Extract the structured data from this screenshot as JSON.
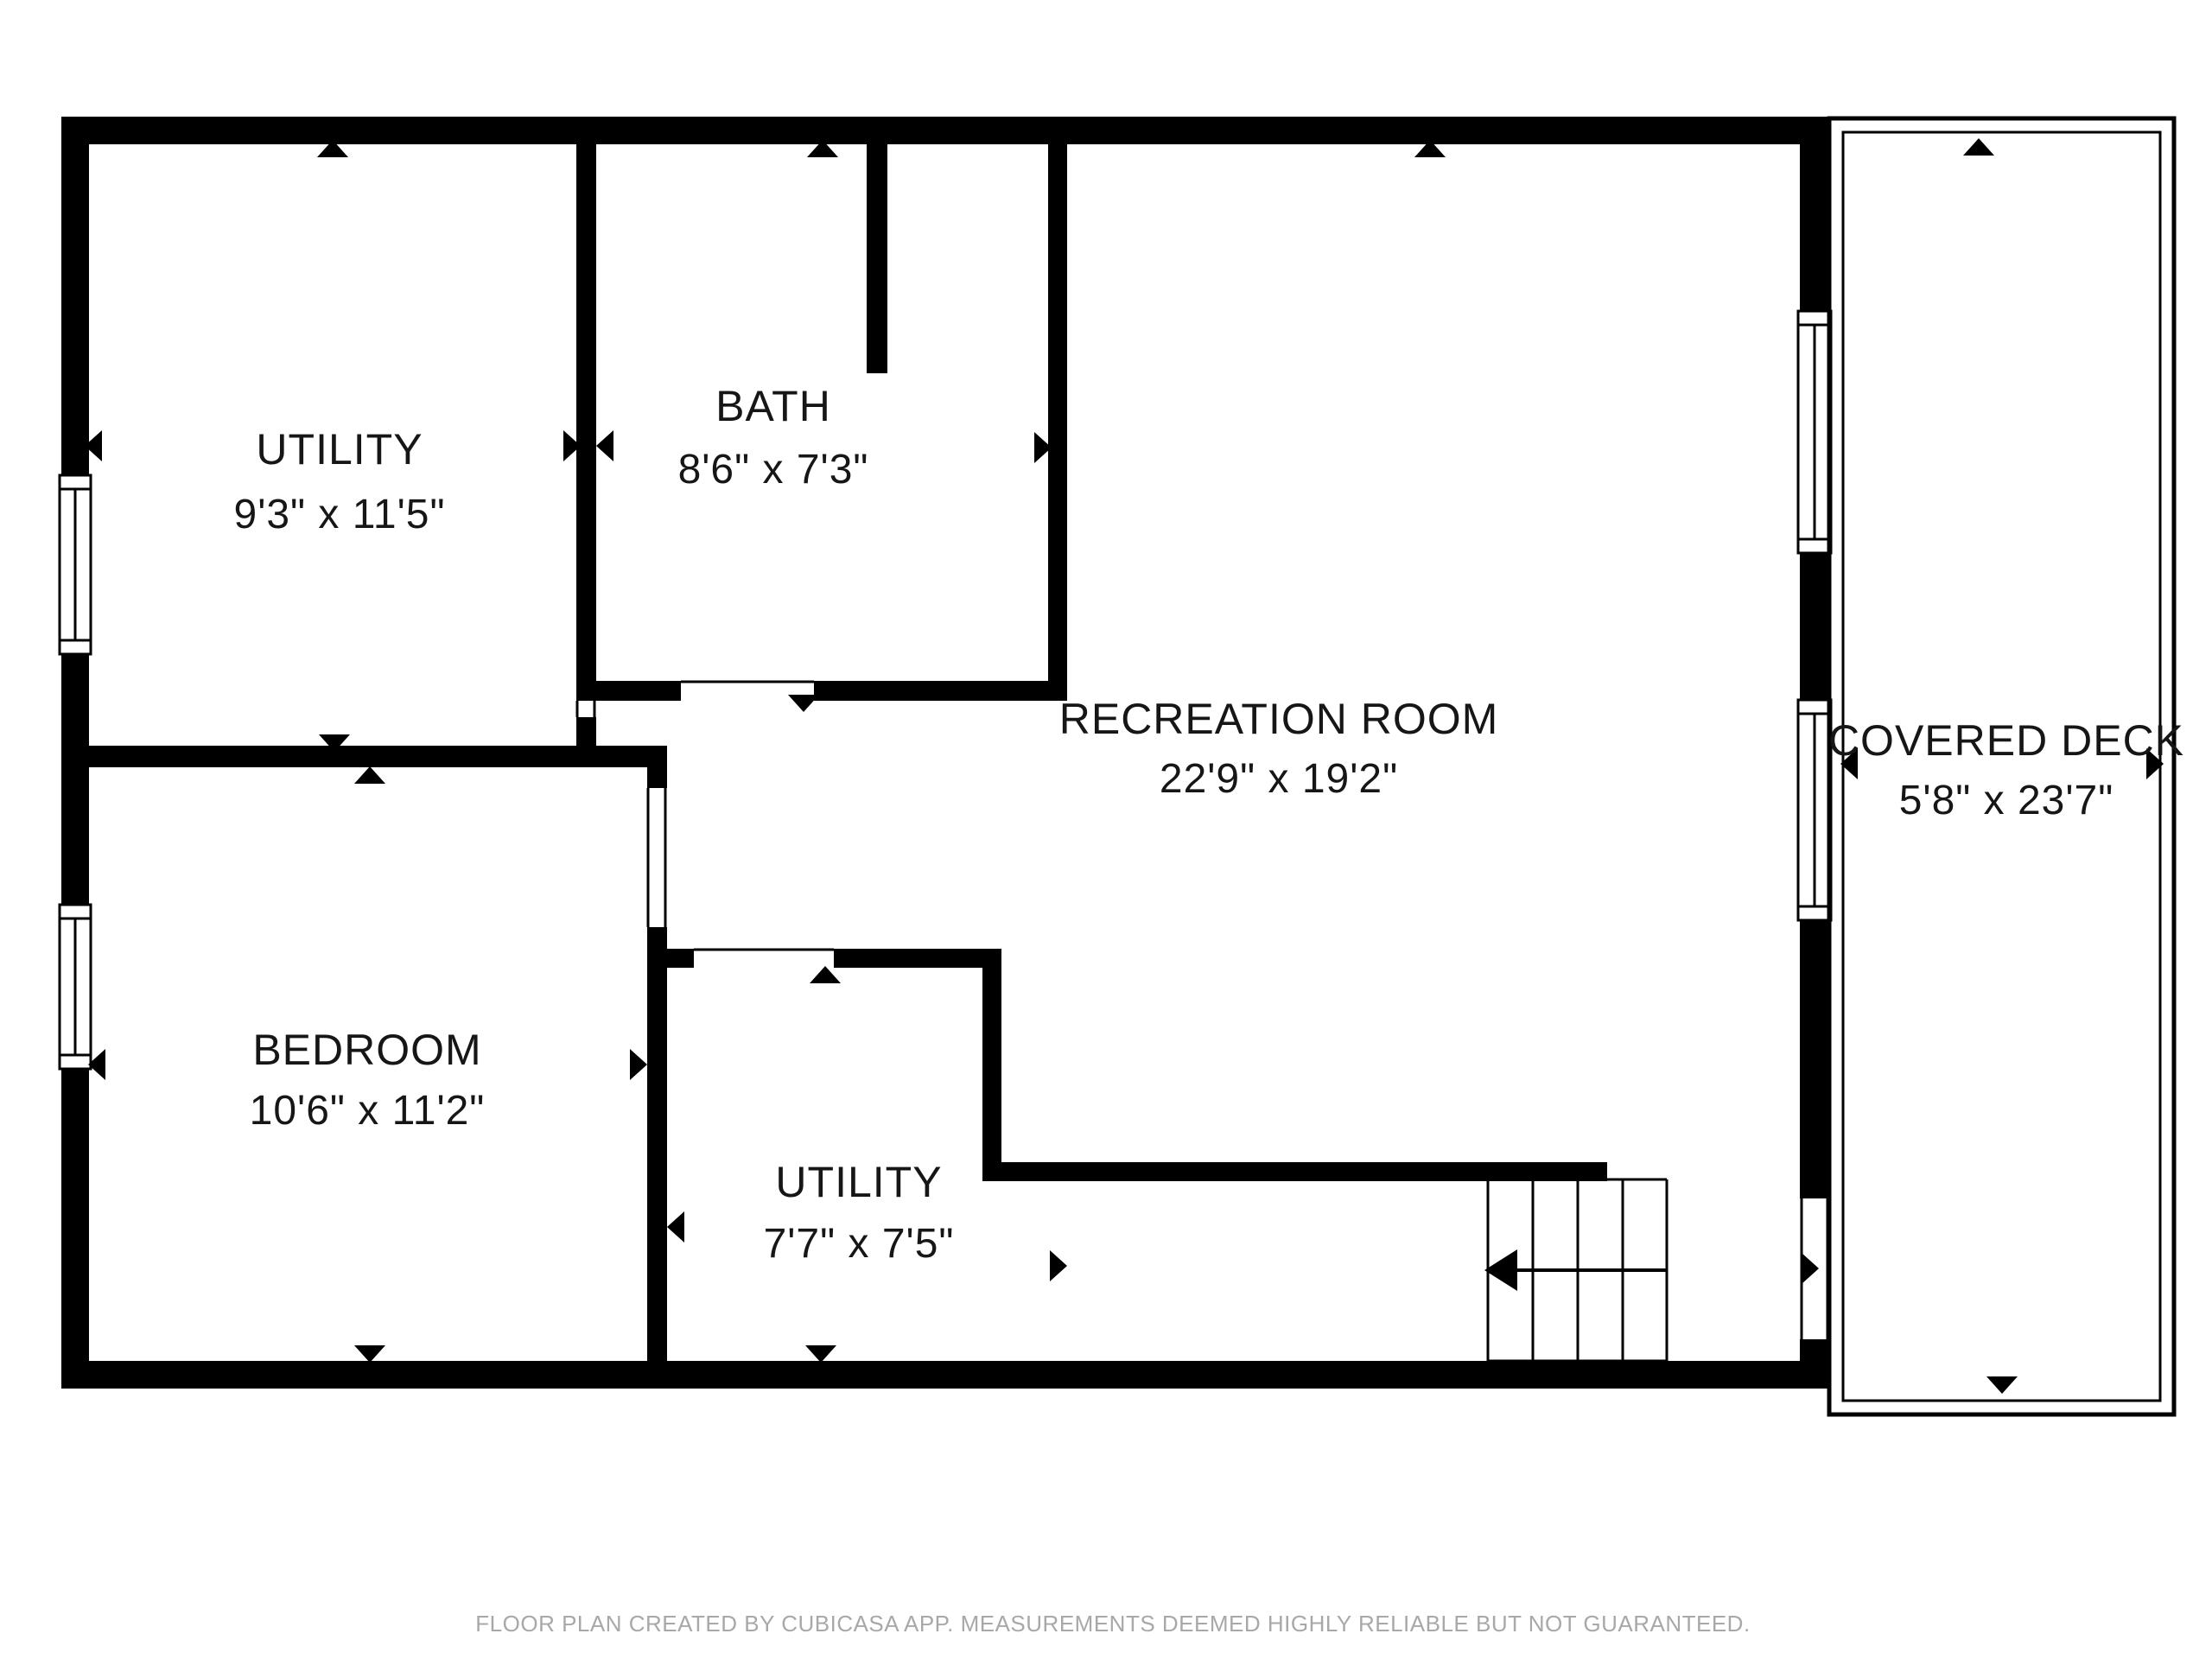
{
  "plan": {
    "creator_note": "FLOOR PLAN CREATED BY CUBICASA APP. MEASUREMENTS DEEMED HIGHLY RELIABLE BUT NOT GUARANTEED."
  },
  "rooms": [
    {
      "id": "utility-upper",
      "name": "UTILITY",
      "dimensions": "9'3\" x 11'5\""
    },
    {
      "id": "bath",
      "name": "BATH",
      "dimensions": "8'6\" x 7'3\""
    },
    {
      "id": "recreation",
      "name": "RECREATION ROOM",
      "dimensions": "22'9\" x 19'2\""
    },
    {
      "id": "bedroom",
      "name": "BEDROOM",
      "dimensions": "10'6\" x 11'2\""
    },
    {
      "id": "utility-lower",
      "name": "UTILITY",
      "dimensions": "7'7\" x 7'5\""
    },
    {
      "id": "covered-deck",
      "name": "COVERED DECK",
      "dimensions": "5'8\" x 23'7\""
    }
  ],
  "colors": {
    "walls": "#000000",
    "background": "#ffffff",
    "label_text": "#161616",
    "footer_text": "#a8a8a8"
  },
  "icons": {
    "dimension_arrow": "small solid triangle pointing outward from room edge",
    "stairs_direction_arrow": "long left-pointing arrow across stair treads"
  }
}
